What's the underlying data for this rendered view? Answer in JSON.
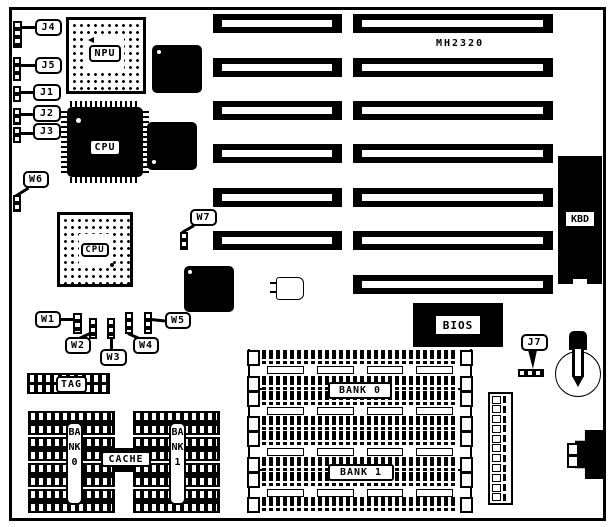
{
  "board": {
    "model": "MH2320"
  },
  "jumpers": {
    "j4": "J4",
    "j5": "J5",
    "j1": "J1",
    "j2": "J2",
    "j3": "J3",
    "w6": "W6",
    "w7": "W7",
    "w1": "W1",
    "w2": "W2",
    "w3": "W3",
    "w4": "W4",
    "w5": "W5",
    "j7": "J7"
  },
  "chips": {
    "npu": "NPU",
    "cpu_qfp": "CPU",
    "cpu_pga": "CPU",
    "bios": "BIOS",
    "kbd": "KBD"
  },
  "memory": {
    "tag": "TAG",
    "cache": "CACHE",
    "cache_bank0": "BANK0",
    "cache_bank1": "BANK1",
    "simm_bank0": "BANK 0",
    "simm_bank1": "BANK 1"
  },
  "colors": {
    "ink": "#000000",
    "paper": "#ffffff"
  }
}
